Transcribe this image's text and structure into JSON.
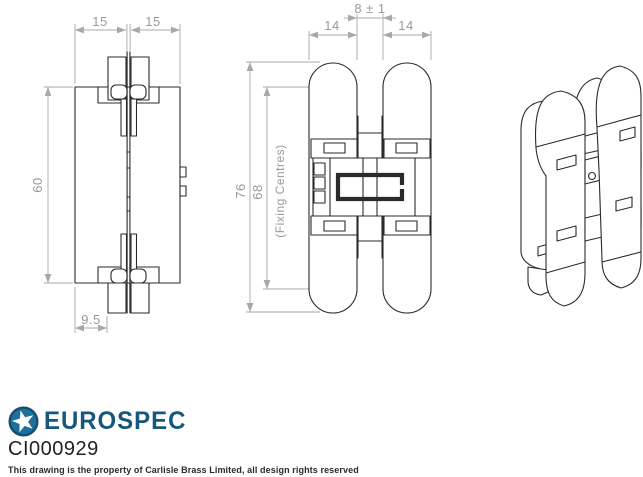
{
  "drawing": {
    "plan_view": {
      "dim_top_left": "15",
      "dim_top_right": "15",
      "dim_height": "60",
      "dim_bottom": "9.5"
    },
    "front_view": {
      "dim_gap": "8 ± 1",
      "dim_leaf_left": "14",
      "dim_leaf_right": "14",
      "dim_overall": "76",
      "dim_fixing": "68",
      "fixing_note": "(Fixing Centres)"
    }
  },
  "footer": {
    "brand": "EUROSPEC",
    "product_code": "CI000929",
    "disclaimer": "This drawing is the property of Carlisle Brass Limited, all design rights reserved"
  },
  "icons": {
    "logo": "star-in-circle"
  },
  "colors": {
    "brand_blue": "#15587B",
    "logo_fill": "#1F6F9C",
    "line_black": "#2A2A2A",
    "dimension_gray": "#A0A0A0"
  }
}
